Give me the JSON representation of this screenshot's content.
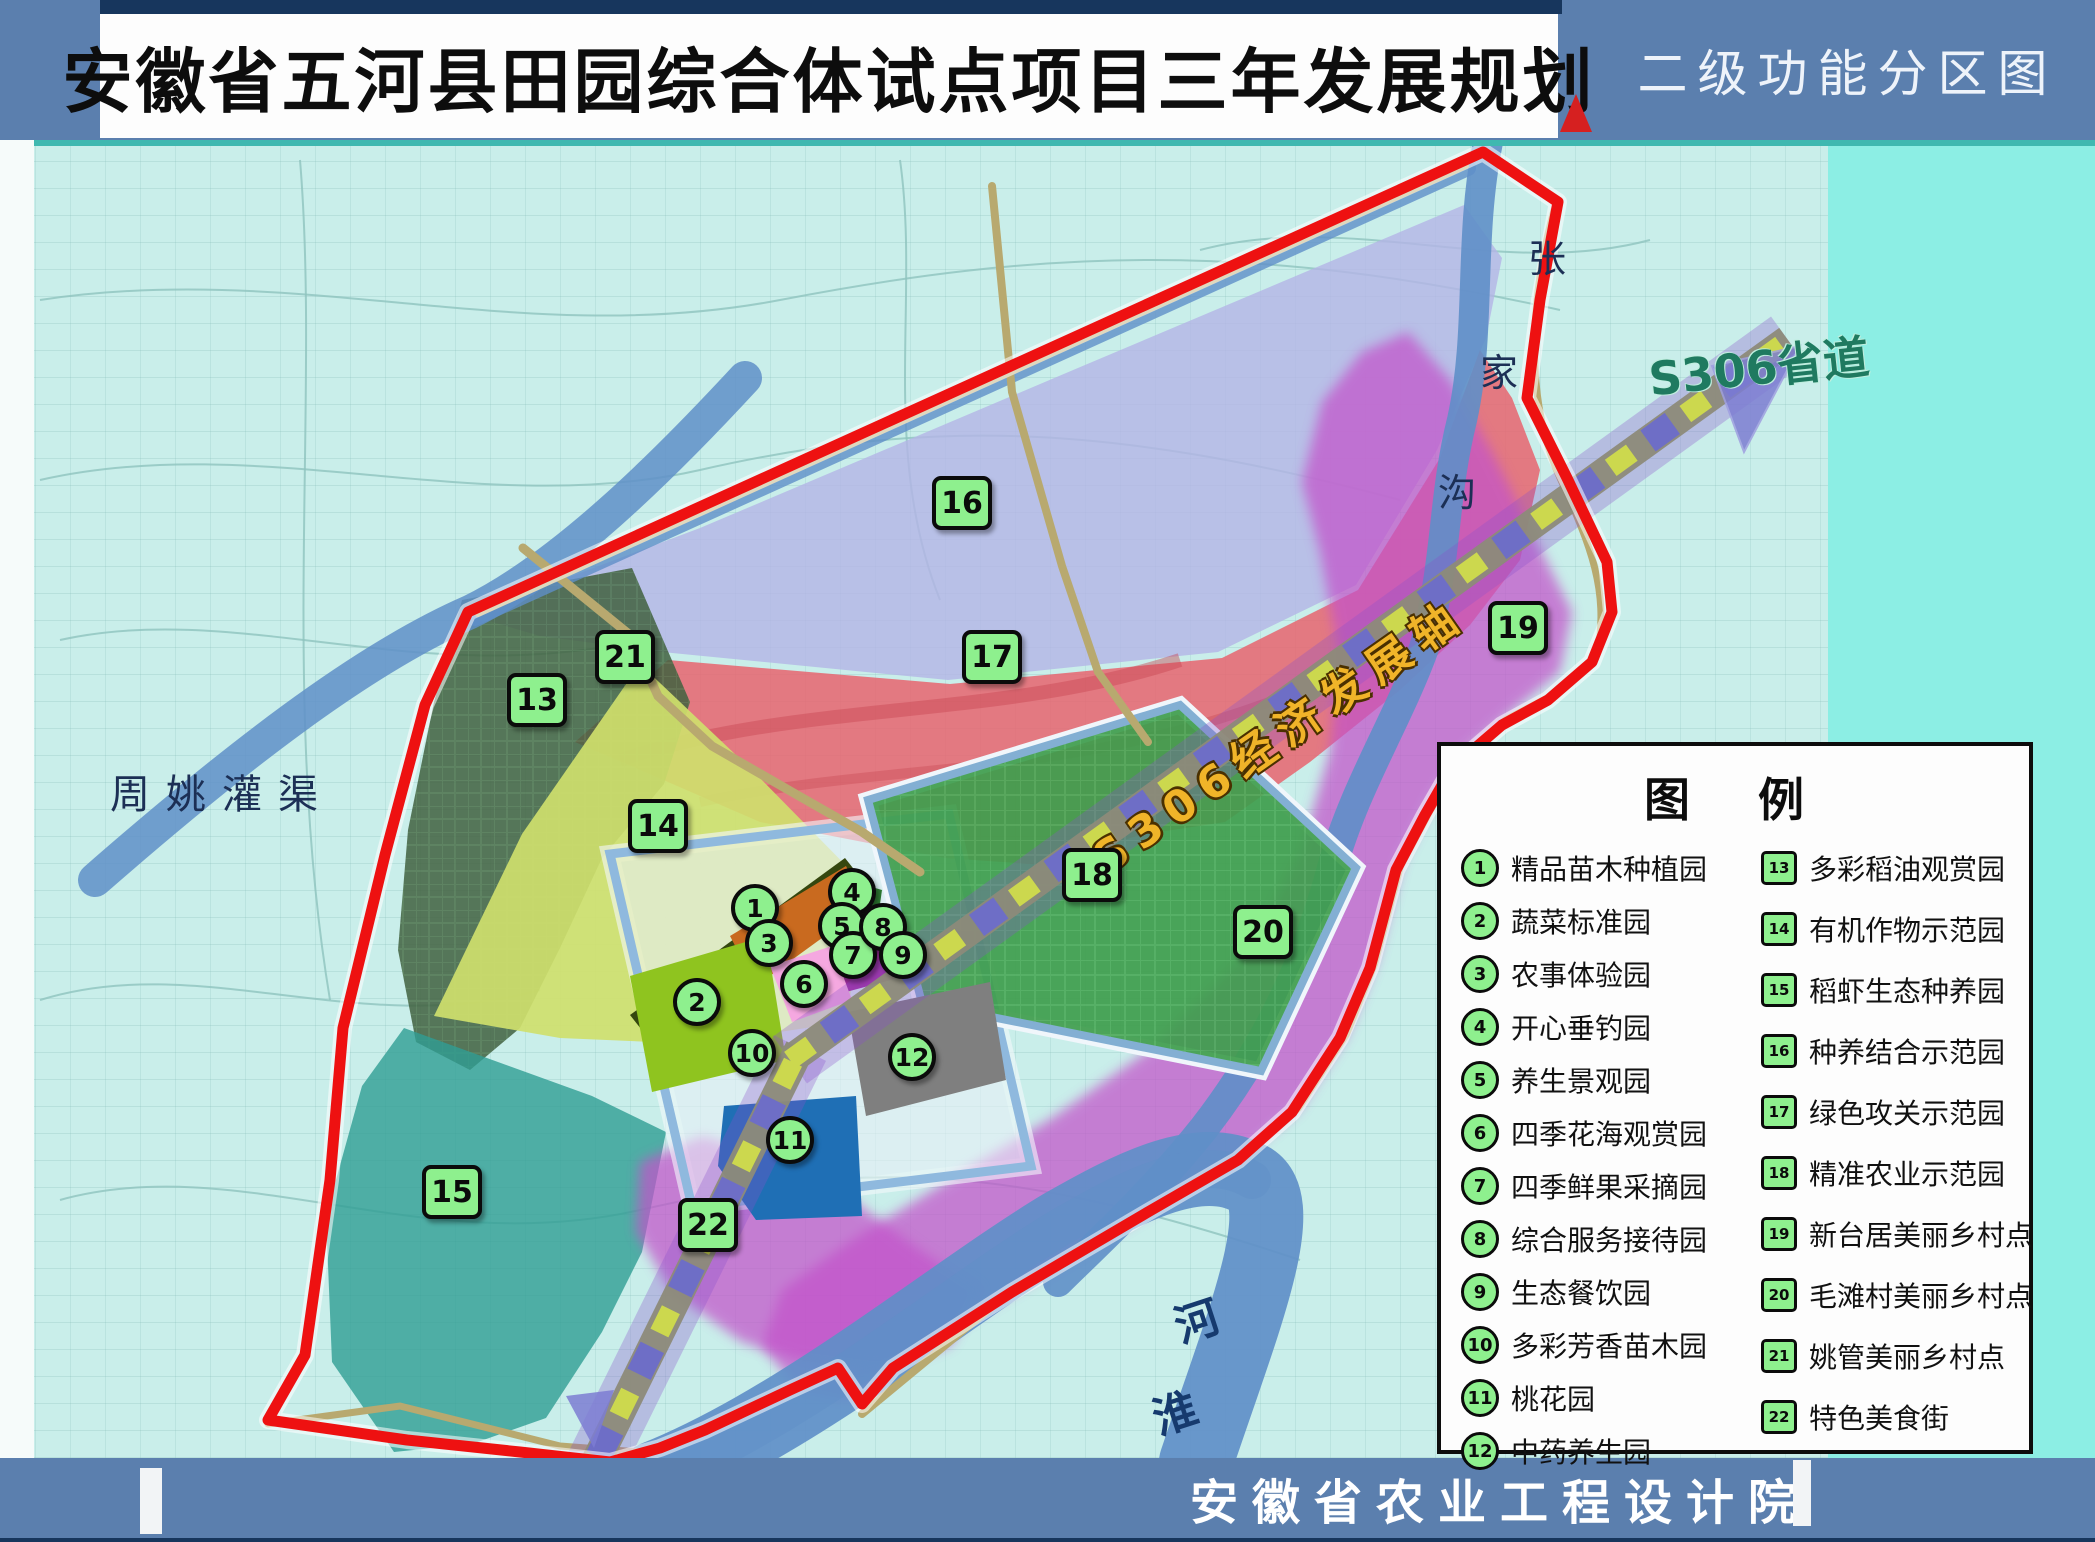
{
  "header": {
    "title": "安徽省五河县田园综合体试点项目三年发展规划",
    "right_label": "二级功能分区图"
  },
  "footer": {
    "org": "安徽省农业工程设计院"
  },
  "map": {
    "labels": {
      "canal": "周姚灌渠",
      "zhangjiagou_chars": [
        "张",
        "家",
        "沟"
      ],
      "axis": "S306经济发展轴",
      "road": "S306省道",
      "huaihe_chars": [
        "淮",
        "河"
      ]
    },
    "markers": [
      {
        "id": "1",
        "kind": "circle",
        "x": 755,
        "y": 908
      },
      {
        "id": "2",
        "kind": "circle",
        "x": 697,
        "y": 1002
      },
      {
        "id": "3",
        "kind": "circle",
        "x": 769,
        "y": 943
      },
      {
        "id": "4",
        "kind": "circle",
        "x": 852,
        "y": 892
      },
      {
        "id": "5",
        "kind": "circle",
        "x": 842,
        "y": 926
      },
      {
        "id": "6",
        "kind": "circle",
        "x": 804,
        "y": 984
      },
      {
        "id": "7",
        "kind": "circle",
        "x": 853,
        "y": 955
      },
      {
        "id": "8",
        "kind": "circle",
        "x": 883,
        "y": 927
      },
      {
        "id": "9",
        "kind": "circle",
        "x": 903,
        "y": 955
      },
      {
        "id": "10",
        "kind": "circle",
        "x": 752,
        "y": 1053
      },
      {
        "id": "11",
        "kind": "circle",
        "x": 790,
        "y": 1140
      },
      {
        "id": "12",
        "kind": "circle",
        "x": 912,
        "y": 1057
      },
      {
        "id": "13",
        "kind": "square",
        "x": 537,
        "y": 700
      },
      {
        "id": "14",
        "kind": "square",
        "x": 658,
        "y": 826
      },
      {
        "id": "15",
        "kind": "square",
        "x": 452,
        "y": 1192
      },
      {
        "id": "16",
        "kind": "square",
        "x": 962,
        "y": 503
      },
      {
        "id": "17",
        "kind": "square",
        "x": 992,
        "y": 657
      },
      {
        "id": "18",
        "kind": "square",
        "x": 1092,
        "y": 875
      },
      {
        "id": "19",
        "kind": "square",
        "x": 1518,
        "y": 628
      },
      {
        "id": "20",
        "kind": "square",
        "x": 1263,
        "y": 932
      },
      {
        "id": "21",
        "kind": "square",
        "x": 625,
        "y": 657
      },
      {
        "id": "22",
        "kind": "square",
        "x": 708,
        "y": 1225
      }
    ]
  },
  "legend": {
    "title": "图 例",
    "col1": [
      {
        "id": "1",
        "label": "精品苗木种植园"
      },
      {
        "id": "2",
        "label": "蔬菜标准园"
      },
      {
        "id": "3",
        "label": "农事体验园"
      },
      {
        "id": "4",
        "label": "开心垂钓园"
      },
      {
        "id": "5",
        "label": "养生景观园"
      },
      {
        "id": "6",
        "label": "四季花海观赏园"
      },
      {
        "id": "7",
        "label": "四季鲜果采摘园"
      },
      {
        "id": "8",
        "label": "综合服务接待园"
      },
      {
        "id": "9",
        "label": "生态餐饮园"
      },
      {
        "id": "10",
        "label": "多彩芳香苗木园"
      },
      {
        "id": "11",
        "label": "桃花园"
      },
      {
        "id": "12",
        "label": "中药养生园"
      }
    ],
    "col2": [
      {
        "id": "13",
        "label": "多彩稻油观赏园"
      },
      {
        "id": "14",
        "label": "有机作物示范园"
      },
      {
        "id": "15",
        "label": "稻虾生态种养园"
      },
      {
        "id": "16",
        "label": "种养结合示范园"
      },
      {
        "id": "17",
        "label": "绿色攻关示范园"
      },
      {
        "id": "18",
        "label": "精准农业示范园"
      },
      {
        "id": "19",
        "label": "新台居美丽乡村点"
      },
      {
        "id": "20",
        "label": "毛滩村美丽乡村点"
      },
      {
        "id": "21",
        "label": "姚管美丽乡村点"
      },
      {
        "id": "22",
        "label": "特色美食街"
      }
    ]
  },
  "colors": {
    "header_blue": "#5b7fae",
    "boundary_red": "#ee1111",
    "marker_green": "#8ef08e",
    "zone16_lavender": "#b4b4e6",
    "zone17_red": "#e7646e",
    "zone13_darkgreen": "#41613f",
    "zone14_yellowgreen": "#cfdf6c",
    "zone15_teal": "#2f9d93",
    "zone18_green": "#3f9e4d",
    "magenta": "#c352ca",
    "river_blue": "#5f8fc8",
    "axis_gold_text": "#f0b429"
  }
}
